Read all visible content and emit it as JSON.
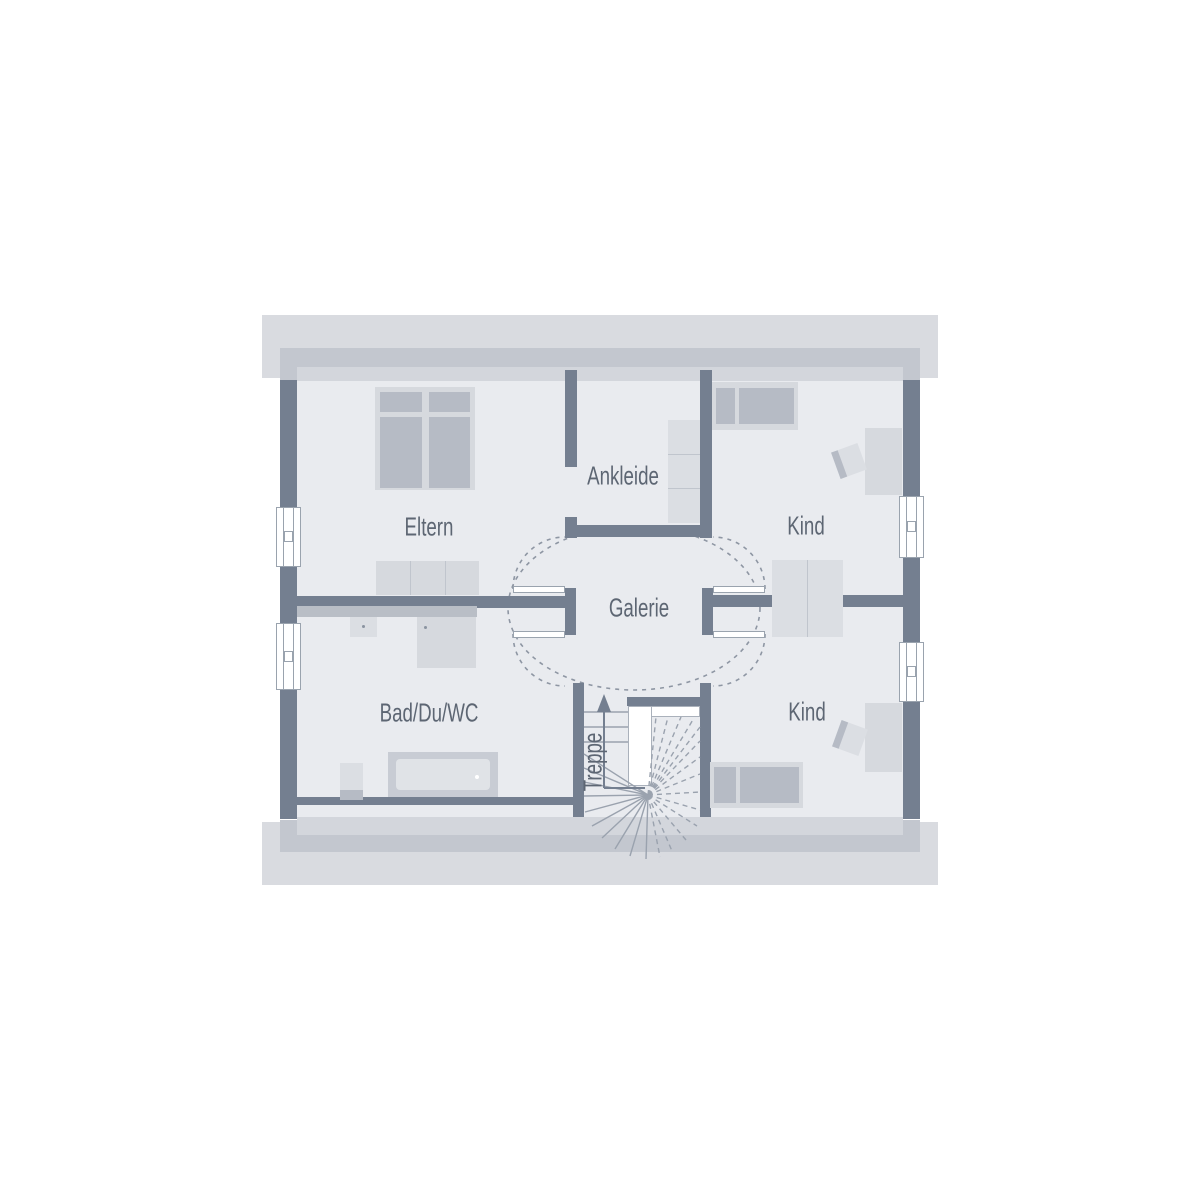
{
  "plan_title": "attic floor plan",
  "palette": {
    "roof": "#d9dbe0",
    "eave": "#c3c7cf",
    "strip": "#d3d6dc",
    "floor": "#e9ebef",
    "wall": "#747f90",
    "counter": "#b9bec6",
    "furn": "#d6d9de",
    "panel": "#b6bbc5",
    "dresser": "#dbdee3",
    "divline": "#c0c5cd",
    "tubouter": "#c8ccd4",
    "tubinner": "#e0e3e7",
    "line": "#8e96a3",
    "tread": "#9aa2ae",
    "text": "#5d6673",
    "winborder": "#9aa3ae",
    "voidline": "#aab1bb",
    "dotcol": "#8a93a0"
  },
  "rooms": {
    "eltern": {
      "label": "Eltern"
    },
    "ankleide": {
      "label": "Ankleide"
    },
    "kind_top": {
      "label": "Kind"
    },
    "kind_bottom": {
      "label": "Kind"
    },
    "galerie": {
      "label": "Galerie"
    },
    "bad": {
      "label": "Bad/Du/WC"
    },
    "treppe": {
      "label": "Treppe"
    }
  }
}
